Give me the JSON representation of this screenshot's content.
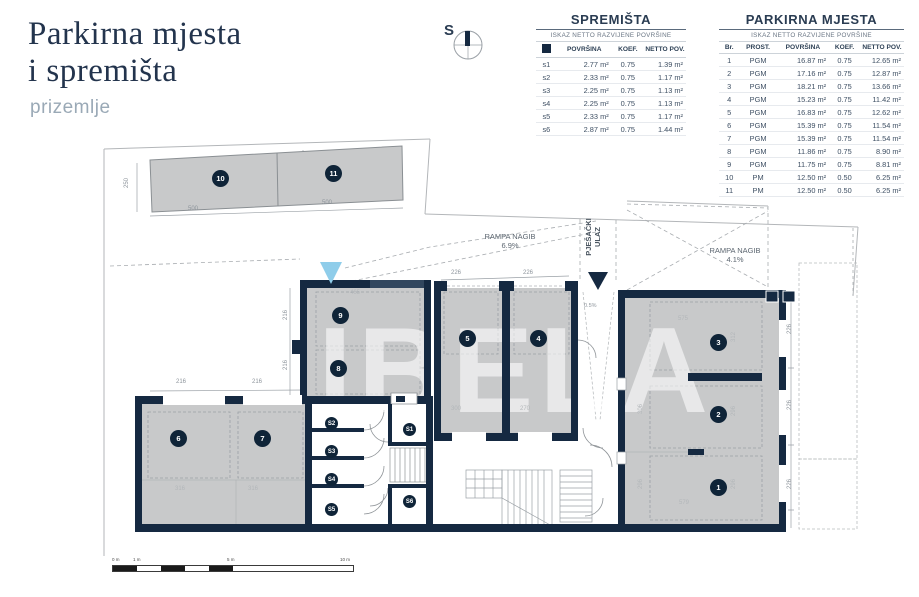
{
  "title": {
    "line1": "Parkirna mjesta",
    "line2": "i spremišta",
    "subtitle": "prizemlje"
  },
  "compass": {
    "label": "S"
  },
  "tables": {
    "spremista": {
      "title": "SPREMIŠTA",
      "subtitle": "ISKAZ NETTO RAZVIJENE POVRŠINE",
      "headers": [
        "",
        "POVRŠINA",
        "KOEF.",
        "NETTO POV."
      ],
      "rows": [
        [
          "s1",
          "2.77 m²",
          "0.75",
          "1.39 m²"
        ],
        [
          "s2",
          "2.33 m²",
          "0.75",
          "1.17 m²"
        ],
        [
          "s3",
          "2.25 m²",
          "0.75",
          "1.13 m²"
        ],
        [
          "s4",
          "2.25 m²",
          "0.75",
          "1.13 m²"
        ],
        [
          "s5",
          "2.33 m²",
          "0.75",
          "1.17 m²"
        ],
        [
          "s6",
          "2.87 m²",
          "0.75",
          "1.44 m²"
        ]
      ]
    },
    "parkirna": {
      "title": "PARKIRNA MJESTA",
      "subtitle": "ISKAZ NETTO RAZVIJENE POVRŠINE",
      "headers": [
        "Br.",
        "PROST.",
        "POVRŠINA",
        "KOEF.",
        "NETTO POV."
      ],
      "rows": [
        [
          "1",
          "PGM",
          "16.87 m²",
          "0.75",
          "12.65 m²"
        ],
        [
          "2",
          "PGM",
          "17.16 m²",
          "0.75",
          "12.87 m²"
        ],
        [
          "3",
          "PGM",
          "18.21 m²",
          "0.75",
          "13.66 m²"
        ],
        [
          "4",
          "PGM",
          "15.23 m²",
          "0.75",
          "11.42 m²"
        ],
        [
          "5",
          "PGM",
          "16.83 m²",
          "0.75",
          "12.62 m²"
        ],
        [
          "6",
          "PGM",
          "15.39 m²",
          "0.75",
          "11.54 m²"
        ],
        [
          "7",
          "PGM",
          "15.39 m²",
          "0.75",
          "11.54 m²"
        ],
        [
          "8",
          "PGM",
          "11.86 m²",
          "0.75",
          "8.90 m²"
        ],
        [
          "9",
          "PGM",
          "11.75 m²",
          "0.75",
          "8.81 m²"
        ],
        [
          "10",
          "PM",
          "12.50 m²",
          "0.50",
          "6.25 m²"
        ],
        [
          "11",
          "PM",
          "12.50 m²",
          "0.50",
          "6.25 m²"
        ]
      ]
    }
  },
  "plan": {
    "watermark": "IBELA",
    "ramp1_label": "RAMPA NAGIB",
    "ramp1_value": "6.9%",
    "ramp2_label": "RAMPA NAGIB",
    "ramp2_value": "4.1%",
    "pedestrian_line1": "PJEŠAČKI",
    "pedestrian_line2": "ULAZ",
    "slope": "0.5%",
    "badges": {
      "b1": "1",
      "b2": "2",
      "b3": "3",
      "b4": "4",
      "b5": "5",
      "b6": "6",
      "b7": "7",
      "b8": "8",
      "b9": "9",
      "b10": "10",
      "b11": "11",
      "s1": "S1",
      "s2": "S2",
      "s3": "S3",
      "s4": "S4",
      "s5": "S5",
      "s6": "S6"
    },
    "dims": {
      "d500a": "500",
      "d500b": "500",
      "d250": "250",
      "d465": "465",
      "d216v1": "216",
      "d216v2": "216",
      "d216h1": "216",
      "d216h2": "216",
      "d226a": "226",
      "d226b": "226",
      "d300": "300",
      "d270": "270",
      "d316a": "316",
      "d316b": "316",
      "d575": "575",
      "d312": "312",
      "d306": "306",
      "d296a": "296",
      "d296b": "296",
      "d296c": "296",
      "d579": "579",
      "d226r1": "226",
      "d226r2": "226",
      "d226r3": "226"
    }
  },
  "scalebar": {
    "l0": "0 m",
    "l1": "1 m",
    "l5": "5 m",
    "l10": "10 m"
  }
}
